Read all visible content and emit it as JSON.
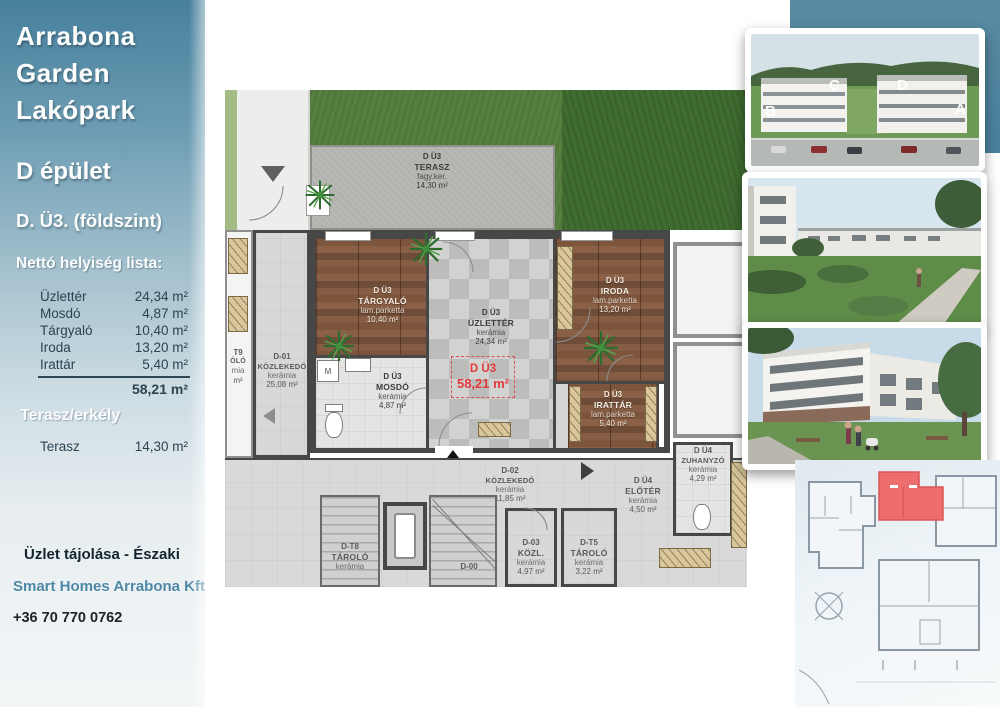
{
  "sidebar": {
    "title_lines": [
      "Arrabona",
      "Garden",
      "Lakópark"
    ],
    "building": "D épület",
    "unit": "D. Ü3. (földszint)",
    "list_title": "Nettó helyiség lista:",
    "rooms": [
      {
        "name": "Üzlettér",
        "area": "24,34 m²"
      },
      {
        "name": "Mosdó",
        "area": "4,87 m²"
      },
      {
        "name": "Tárgyaló",
        "area": "10,40 m²"
      },
      {
        "name": "Iroda",
        "area": "13,20 m²"
      },
      {
        "name": "Irattár",
        "area": "5,40 m²"
      }
    ],
    "total_area": "58,21 m²",
    "terrace_title": "Terasz/erkély",
    "terrace_name": "Terasz",
    "terrace_area": "14,30 m²",
    "orientation": "Üzlet tájolása - Északi",
    "company": "Smart Homes Arrabona Kft",
    "phone": "+36 70 770 0762"
  },
  "plan": {
    "rooms": {
      "terasz": {
        "unit": "D Ü3",
        "name": "TERASZ",
        "material": "fagy.ker.",
        "area": "14,30 m²"
      },
      "targyalo": {
        "unit": "D Ü3",
        "name": "TÁRGYALÓ",
        "material": "lam.parketta",
        "area": "10,40 m²"
      },
      "uzletter": {
        "unit": "D Ü3",
        "name": "ÜZLETTÉR",
        "material": "kerámia",
        "area": "24,34 m²"
      },
      "mosdo": {
        "unit": "D Ü3",
        "name": "MOSDÓ",
        "material": "kerámia",
        "area": "4,87 m²"
      },
      "iroda": {
        "unit": "D Ü3",
        "name": "IRODA",
        "material": "lam.parketta",
        "area": "13,20 m²"
      },
      "irattar": {
        "unit": "D Ü3",
        "name": "IRATTÁR",
        "material": "lam.parketta",
        "area": "5,40 m²"
      },
      "d01": {
        "unit": "D-01",
        "name": "KÖZLEKEDŐ",
        "material": "kerámia",
        "area": "25,08 m²"
      },
      "d02": {
        "unit": "D-02",
        "name": "KÖZLEKEDŐ",
        "material": "kerámia",
        "area": "11,85 m²"
      },
      "d03": {
        "unit": "D-03",
        "name": "KÖZL.",
        "material": "kerámia",
        "area": "4,97 m²"
      },
      "dt5": {
        "unit": "D-T5",
        "name": "TÁROLÓ",
        "material": "kerámia",
        "area": "3,22 m²"
      },
      "dt8": {
        "unit": "D-T8",
        "name": "TÁROLÓ",
        "material": "kerámia"
      },
      "dt9_fragment": {
        "unit": "T9",
        "name": "ÓLÓ",
        "material": "mia",
        "area": "m²"
      },
      "du4_eloter": {
        "unit": "D Ü4",
        "name": "ELŐTÉR",
        "material": "kerámia",
        "area": "4,50 m²"
      },
      "du4_zuhanyzo": {
        "unit": "D Ü4",
        "name": "ZUHANYZÓ",
        "material": "kerámia",
        "area": "4,29 m²"
      }
    },
    "highlight": {
      "unit": "D Ü3",
      "area": "58,21 m²"
    },
    "entrance_label": "D Ü3",
    "d00_label": "D-00",
    "washing_machine_label": "M"
  },
  "photos": {
    "building_letters": [
      "B",
      "C",
      "D",
      "A"
    ]
  },
  "colors": {
    "sidebar_teal": "#47809c",
    "accent_teal": "#4d88a5",
    "highlight_red": "#e23b3b",
    "keyplan_red": "#ee6d6d",
    "grass_green": "#56803e",
    "wood_brown": "#7c5740"
  }
}
